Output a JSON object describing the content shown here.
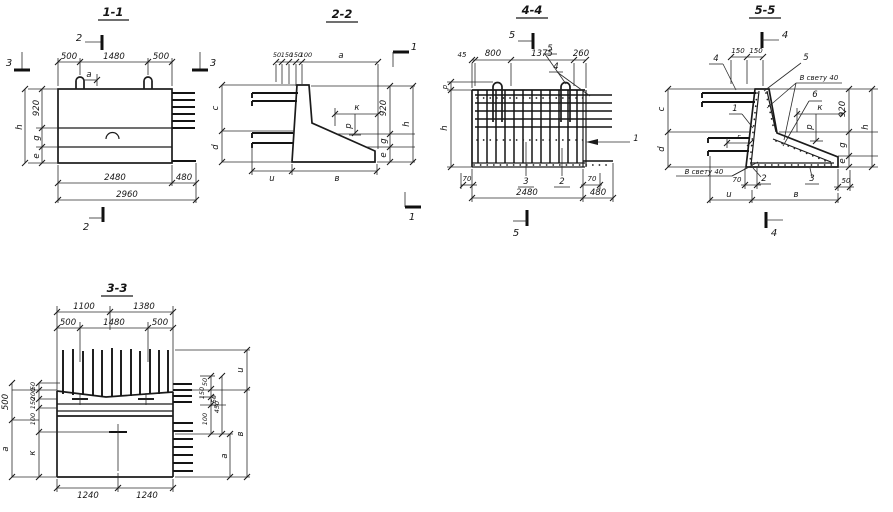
{
  "colors": {
    "paper": "#ffffff",
    "ink": "#1b1b1b"
  },
  "sections": {
    "s1": {
      "title": "1-1",
      "mk_top": "2",
      "mk_bottom": "2",
      "mk_left": "3",
      "mk_right": "3",
      "top": [
        "500",
        "1480",
        "500"
      ],
      "a": "a",
      "left": [
        "h",
        "920",
        "g",
        "e"
      ],
      "bottom": [
        "2480",
        "480",
        "2960"
      ]
    },
    "s2": {
      "title": "2-2",
      "mk": "1",
      "top": [
        "50",
        "150",
        "150",
        "100",
        "a"
      ],
      "left": [
        "c",
        "d"
      ],
      "right": [
        "920",
        "h",
        "g",
        "e"
      ],
      "k": "к",
      "p": "p",
      "bottom": [
        "u",
        "в"
      ]
    },
    "s4": {
      "title": "4-4",
      "mk": "5",
      "top": [
        "45",
        "800",
        "1375",
        "260"
      ],
      "c5": "5",
      "c4": "4",
      "c1": "1",
      "p": "p",
      "h": "h",
      "b70l": "70",
      "b70r": "70",
      "item3": "3",
      "item2": "2",
      "b2480": "2480",
      "b480": "480"
    },
    "s5": {
      "title": "5-5",
      "mk": "4",
      "top": [
        "150",
        "150"
      ],
      "c4": "4",
      "c5": "5",
      "c6": "6",
      "c1": "1",
      "clear_top": "В свету 40",
      "clear_bottom": "В свету 40",
      "k": "к",
      "p": "p",
      "g_dim": "г",
      "left": [
        "c",
        "d"
      ],
      "right": [
        "920",
        "h",
        "g",
        "e"
      ],
      "d70": "70",
      "item2": "2",
      "item3": "3",
      "d50": "50",
      "bottom": [
        "u",
        "в"
      ]
    },
    "s3": {
      "title": "3-3",
      "row1": [
        "1100",
        "1380"
      ],
      "row2": [
        "500",
        "1480",
        "500"
      ],
      "left": [
        "50",
        "200",
        "150",
        "100",
        "500",
        "a",
        "к"
      ],
      "right": [
        "50",
        "150",
        "150",
        "450",
        "100",
        "u",
        "a",
        "в"
      ],
      "bottom": [
        "1240",
        "1240"
      ]
    }
  }
}
